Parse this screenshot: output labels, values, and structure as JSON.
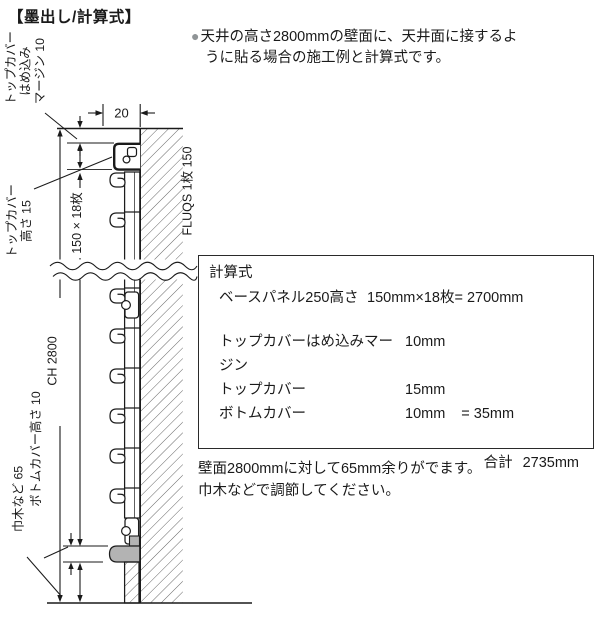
{
  "page": {
    "title": "【墨出し/計算式】"
  },
  "intro": {
    "bullet": "●",
    "line1": "天井の高さ2800mmの壁面に、天井面に接するよ",
    "line2": "うに貼る場合の施工例と計算式です。"
  },
  "diagram": {
    "dim_20": "20",
    "top_margin_label": [
      "トップカバー",
      "はめ込み",
      "マージン 10"
    ],
    "top_cover_label": [
      "トップカバー",
      "高さ 15"
    ],
    "panel_stack_dim": "150 × 18枚",
    "ceiling_height_dim": "CH 2800",
    "bottom_cover_label": "ボトムカバー高さ 10",
    "skirting_label": "巾木など 65",
    "panel_label": "FLUQS 1枚 150"
  },
  "calc_box": {
    "title": "計算式",
    "rows": [
      {
        "label": "ベースパネル250高さ",
        "value": "150mm×18枚= 2700mm",
        "extra": ""
      },
      {
        "label": "トップカバーはめ込みマージン",
        "value": "10mm",
        "extra": ""
      },
      {
        "label": "トップカバー",
        "value": "15mm",
        "extra": ""
      },
      {
        "label": "ボトムカバー",
        "value": "10mm",
        "extra": "= 35mm"
      }
    ],
    "total_label": "合計",
    "total_value": "2735mm"
  },
  "note": {
    "line1": "壁面2800mmに対して65mm余りがでます。",
    "line2": "巾木などで調節してください。"
  }
}
